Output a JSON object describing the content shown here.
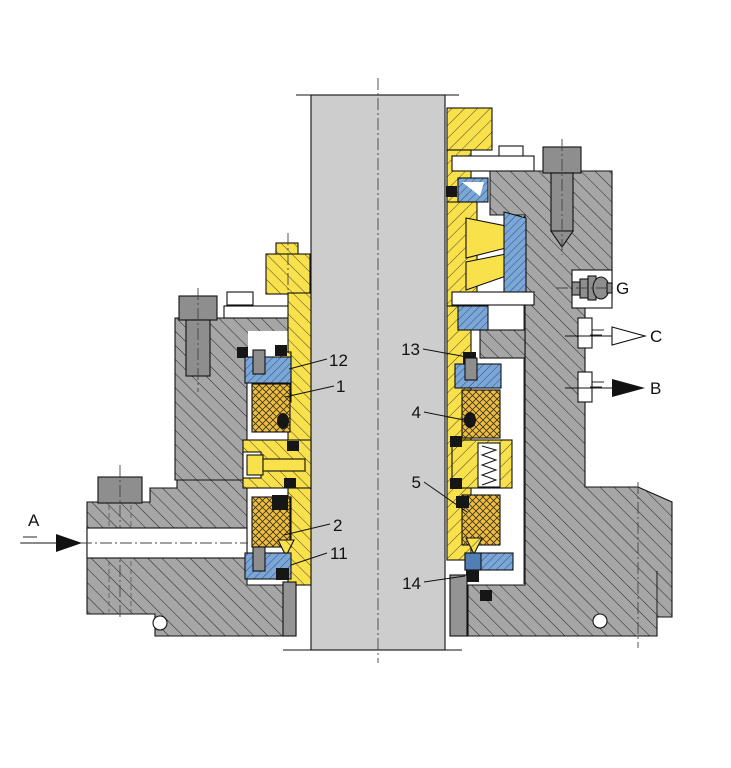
{
  "figure": {
    "type": "engineering-cross-section",
    "subject": "Mechanical seal and bearing assembly on vertical shaft, sectional drawing"
  },
  "labels": {
    "n1": "1",
    "n2": "2",
    "n4": "4",
    "n5": "5",
    "n11": "11",
    "n12": "12",
    "n13": "13",
    "n14": "14"
  },
  "ports": {
    "a": "A",
    "b": "B",
    "c": "C",
    "g": "G"
  },
  "colors": {
    "background": "#ffffff",
    "line": "#111111",
    "shaft_gray": "#cdcdcd",
    "metal_gray": "#a6a6a6",
    "bolt_gray": "#8e8e8e",
    "bore_gray": "#949494",
    "brass_yellow": "#f8e14b",
    "elastomer_orange": "#f2bd3a",
    "bronze_blue": "#7aa7d9",
    "seal_black": "#161616"
  }
}
